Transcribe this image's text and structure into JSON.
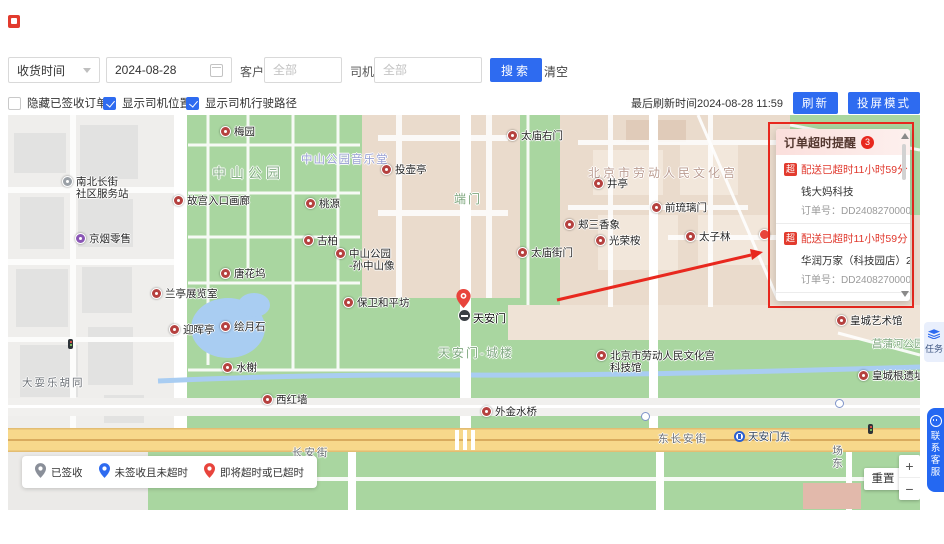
{
  "theme": {
    "accent_blue": "#2e6bf0",
    "alert_red": "#e8281e",
    "poi_color": "#b5413f"
  },
  "header": {
    "filters": {
      "date_type_select": "收货时间",
      "date_value": "2024-08-28",
      "customer_label": "客户",
      "customer_placeholder": "全部",
      "driver_label": "司机",
      "driver_placeholder": "全部",
      "search_button": "搜索",
      "clear_button": "清空"
    },
    "options": {
      "hide_signed": {
        "label": "隐藏已签收订单",
        "checked": false
      },
      "show_driver_pos": {
        "label": "显示司机位置",
        "checked": true
      },
      "show_driver_route": {
        "label": "显示司机行驶路径",
        "checked": true
      }
    },
    "refresh": {
      "last_refresh_text": "最后刷新时间2024-08-28 11:59",
      "refresh_button": "刷新",
      "cast_button": "投屏模式"
    }
  },
  "timeout_panel": {
    "title": "订单超时提醒",
    "badge_count": "3",
    "tag": "超",
    "orders": [
      {
        "status": "配送已超时11小时59分",
        "customer": "钱大妈科技",
        "order_label": "订单号：",
        "order_no": "DD24082700005"
      },
      {
        "status": "配送已超时11小时59分",
        "customer": "华润万家（科技园店）2",
        "order_label": "订单号：",
        "order_no": "DD24082700003"
      },
      {
        "status": "剩余0分",
        "customer": "华润万家（科技园店）2",
        "order_label": "",
        "order_no": ""
      }
    ]
  },
  "map": {
    "tiananmen_label": "天安门",
    "metro_label": "天安门东",
    "area_labels": [
      {
        "text": "中山公园",
        "x": 204,
        "y": 48,
        "cls": "park-lg"
      },
      {
        "text": "中山公园音乐堂",
        "x": 293,
        "y": 36,
        "cls": "music"
      },
      {
        "text": "端门",
        "x": 446,
        "y": 75,
        "cls": "park-md"
      },
      {
        "text": "北京市劳动人民文化宫",
        "x": 580,
        "y": 49,
        "cls": "palace"
      },
      {
        "text": "天安门-城楼",
        "x": 430,
        "y": 229,
        "cls": "park-md"
      },
      {
        "text": "菖蒲河公园",
        "x": 864,
        "y": 221,
        "cls": "park-sm"
      },
      {
        "text": "大耍乐胡同",
        "x": 14,
        "y": 260,
        "cls": "street"
      },
      {
        "text": "长安街",
        "x": 284,
        "y": 330,
        "cls": "street"
      },
      {
        "text": "东长安街",
        "x": 650,
        "y": 316,
        "cls": "street"
      },
      {
        "text": "场东",
        "x": 822,
        "y": 330,
        "cls": "street-v"
      }
    ],
    "pois": [
      {
        "label": "梅园",
        "x": 212,
        "y": 12
      },
      {
        "label": "太庙右门",
        "x": 499,
        "y": 16
      },
      {
        "label": "投壶亭",
        "x": 373,
        "y": 50
      },
      {
        "label": "井亭",
        "x": 585,
        "y": 64
      },
      {
        "label": "故宫入口画廊",
        "x": 165,
        "y": 81
      },
      {
        "label": "桃源",
        "x": 297,
        "y": 84
      },
      {
        "label": "前琉璃门",
        "x": 643,
        "y": 88
      },
      {
        "label": "郏三香象",
        "x": 556,
        "y": 105
      },
      {
        "label": "京烟零售",
        "x": 67,
        "y": 119,
        "color": "#8a56b5"
      },
      {
        "label": "古柏",
        "x": 295,
        "y": 121
      },
      {
        "label": "光荣桉",
        "x": 587,
        "y": 121
      },
      {
        "label": "太子林",
        "x": 677,
        "y": 117
      },
      {
        "label": "中山公园\n-孙中山像",
        "x": 327,
        "y": 134
      },
      {
        "label": "太庙街门",
        "x": 509,
        "y": 133
      },
      {
        "label": "唐花坞",
        "x": 212,
        "y": 154
      },
      {
        "label": "兰亭展览室",
        "x": 143,
        "y": 174
      },
      {
        "label": "保卫和平坊",
        "x": 335,
        "y": 183
      },
      {
        "label": "迎晖亭",
        "x": 161,
        "y": 210
      },
      {
        "label": "绘月石",
        "x": 212,
        "y": 207
      },
      {
        "label": "水榭",
        "x": 214,
        "y": 248
      },
      {
        "label": "西红墙",
        "x": 254,
        "y": 280
      },
      {
        "label": "外金水桥",
        "x": 473,
        "y": 292
      },
      {
        "label": "北京市劳动人民文化宫\n科技馆",
        "x": 588,
        "y": 236
      },
      {
        "label": "皇城艺术馆",
        "x": 828,
        "y": 201
      },
      {
        "label": "皇城根遗址",
        "x": 850,
        "y": 256
      },
      {
        "label": "南北长街\n社区服务站",
        "x": 54,
        "y": 62,
        "color": "#9aa0a6"
      }
    ],
    "legend": [
      {
        "label": "已签收",
        "color": "#8a8f99"
      },
      {
        "label": "未签收且未超时",
        "color": "#2e6bf0"
      },
      {
        "label": "即将超时或已超时",
        "color": "#e8443c"
      }
    ],
    "reset_button": "重置",
    "zoom_in": "+",
    "zoom_out": "−"
  },
  "side_tabs": {
    "task_label": "任务",
    "service_label": "联系客服"
  }
}
